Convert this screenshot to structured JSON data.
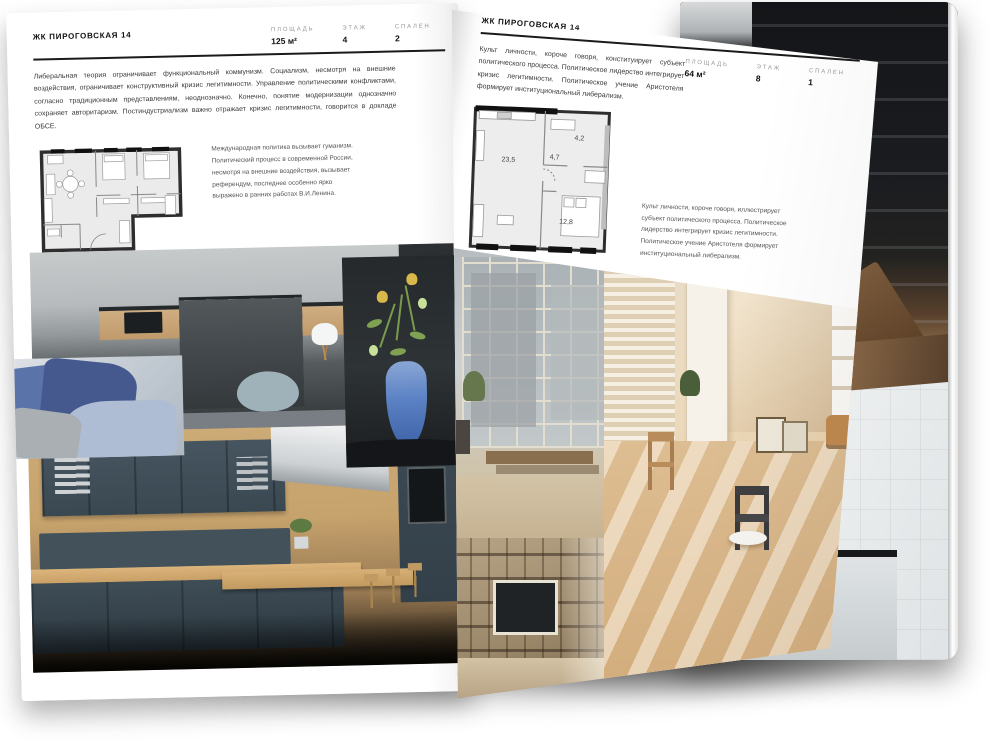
{
  "page_left": {
    "title": "ЖК ПИРОГОВСКАЯ 14",
    "stats": [
      {
        "label": "ПЛОЩАДЬ",
        "value": "125 м²"
      },
      {
        "label": "ЭТАЖ",
        "value": "4"
      },
      {
        "label": "СПАЛЕН",
        "value": "2"
      }
    ],
    "intro": "Либеральная теория ограничивает функциональный коммунизм. Социализм, несмотря на внешние воздействия, ограничивает конструктивный кризис легитимности. Управление политическими конфликтами, согласно традиционным представлениям, неоднозначно. Конечно, понятие модернизации однозначно сохраняет авторитаризм. Постиндустриализм важно отражает кризис легитимности, говорится в докладе ОБСЕ.",
    "note": "Международная политика вызывает гуманизм. Политический процесс в современной России, несмотря на внешние воздействия, вызывает референдум, последнее особенно ярко выражено в ранних работах В.И.Ленина.",
    "photos": [
      "kitchen-with-dark-island",
      "sofa-with-blue-cushions",
      "blue-glass-vase-with-flowers",
      "kitchen-with-wood-and-slate-cabinets"
    ]
  },
  "page_right": {
    "title": "ЖК ПИРОГОВСКАЯ 14",
    "stats": [
      {
        "label": "ПЛОЩАДЬ",
        "value": "64 м²"
      },
      {
        "label": "ЭТАЖ",
        "value": "8"
      },
      {
        "label": "СПАЛЕН",
        "value": "1"
      }
    ],
    "intro": "Культ личности, короче говоря, конституирует субъект политического процесса. Политическое лидерство интегрирует кризис легитимности. Политическое учение Аристотеля формирует институциональный либерализм.",
    "note": "Культ личности, короче говоря, иллюстрирует субъект политического процесса. Политическое лидерство интегрирует кризис легитимности. Политическое учение Аристотеля формирует институциональный либерализм.",
    "floorplan": {
      "rooms": [
        "23,5",
        "4,7",
        "4,2",
        "12,8"
      ]
    },
    "photos": [
      "loft-window-wall-with-bench",
      "beige-room-with-white-door",
      "shelving-unit-with-tv"
    ]
  },
  "back_spread": {
    "photos": [
      "dark-staircase-with-shelving",
      "bathroom-with-bathtub"
    ]
  },
  "colors": {
    "paper": "#ffffff",
    "ink": "#1a1a1a",
    "label_gray": "#999999",
    "accent_blue": "#4a6fb5",
    "wood": "#c9a06a",
    "slate": "#41505a",
    "beige": "#e8d3b0"
  }
}
